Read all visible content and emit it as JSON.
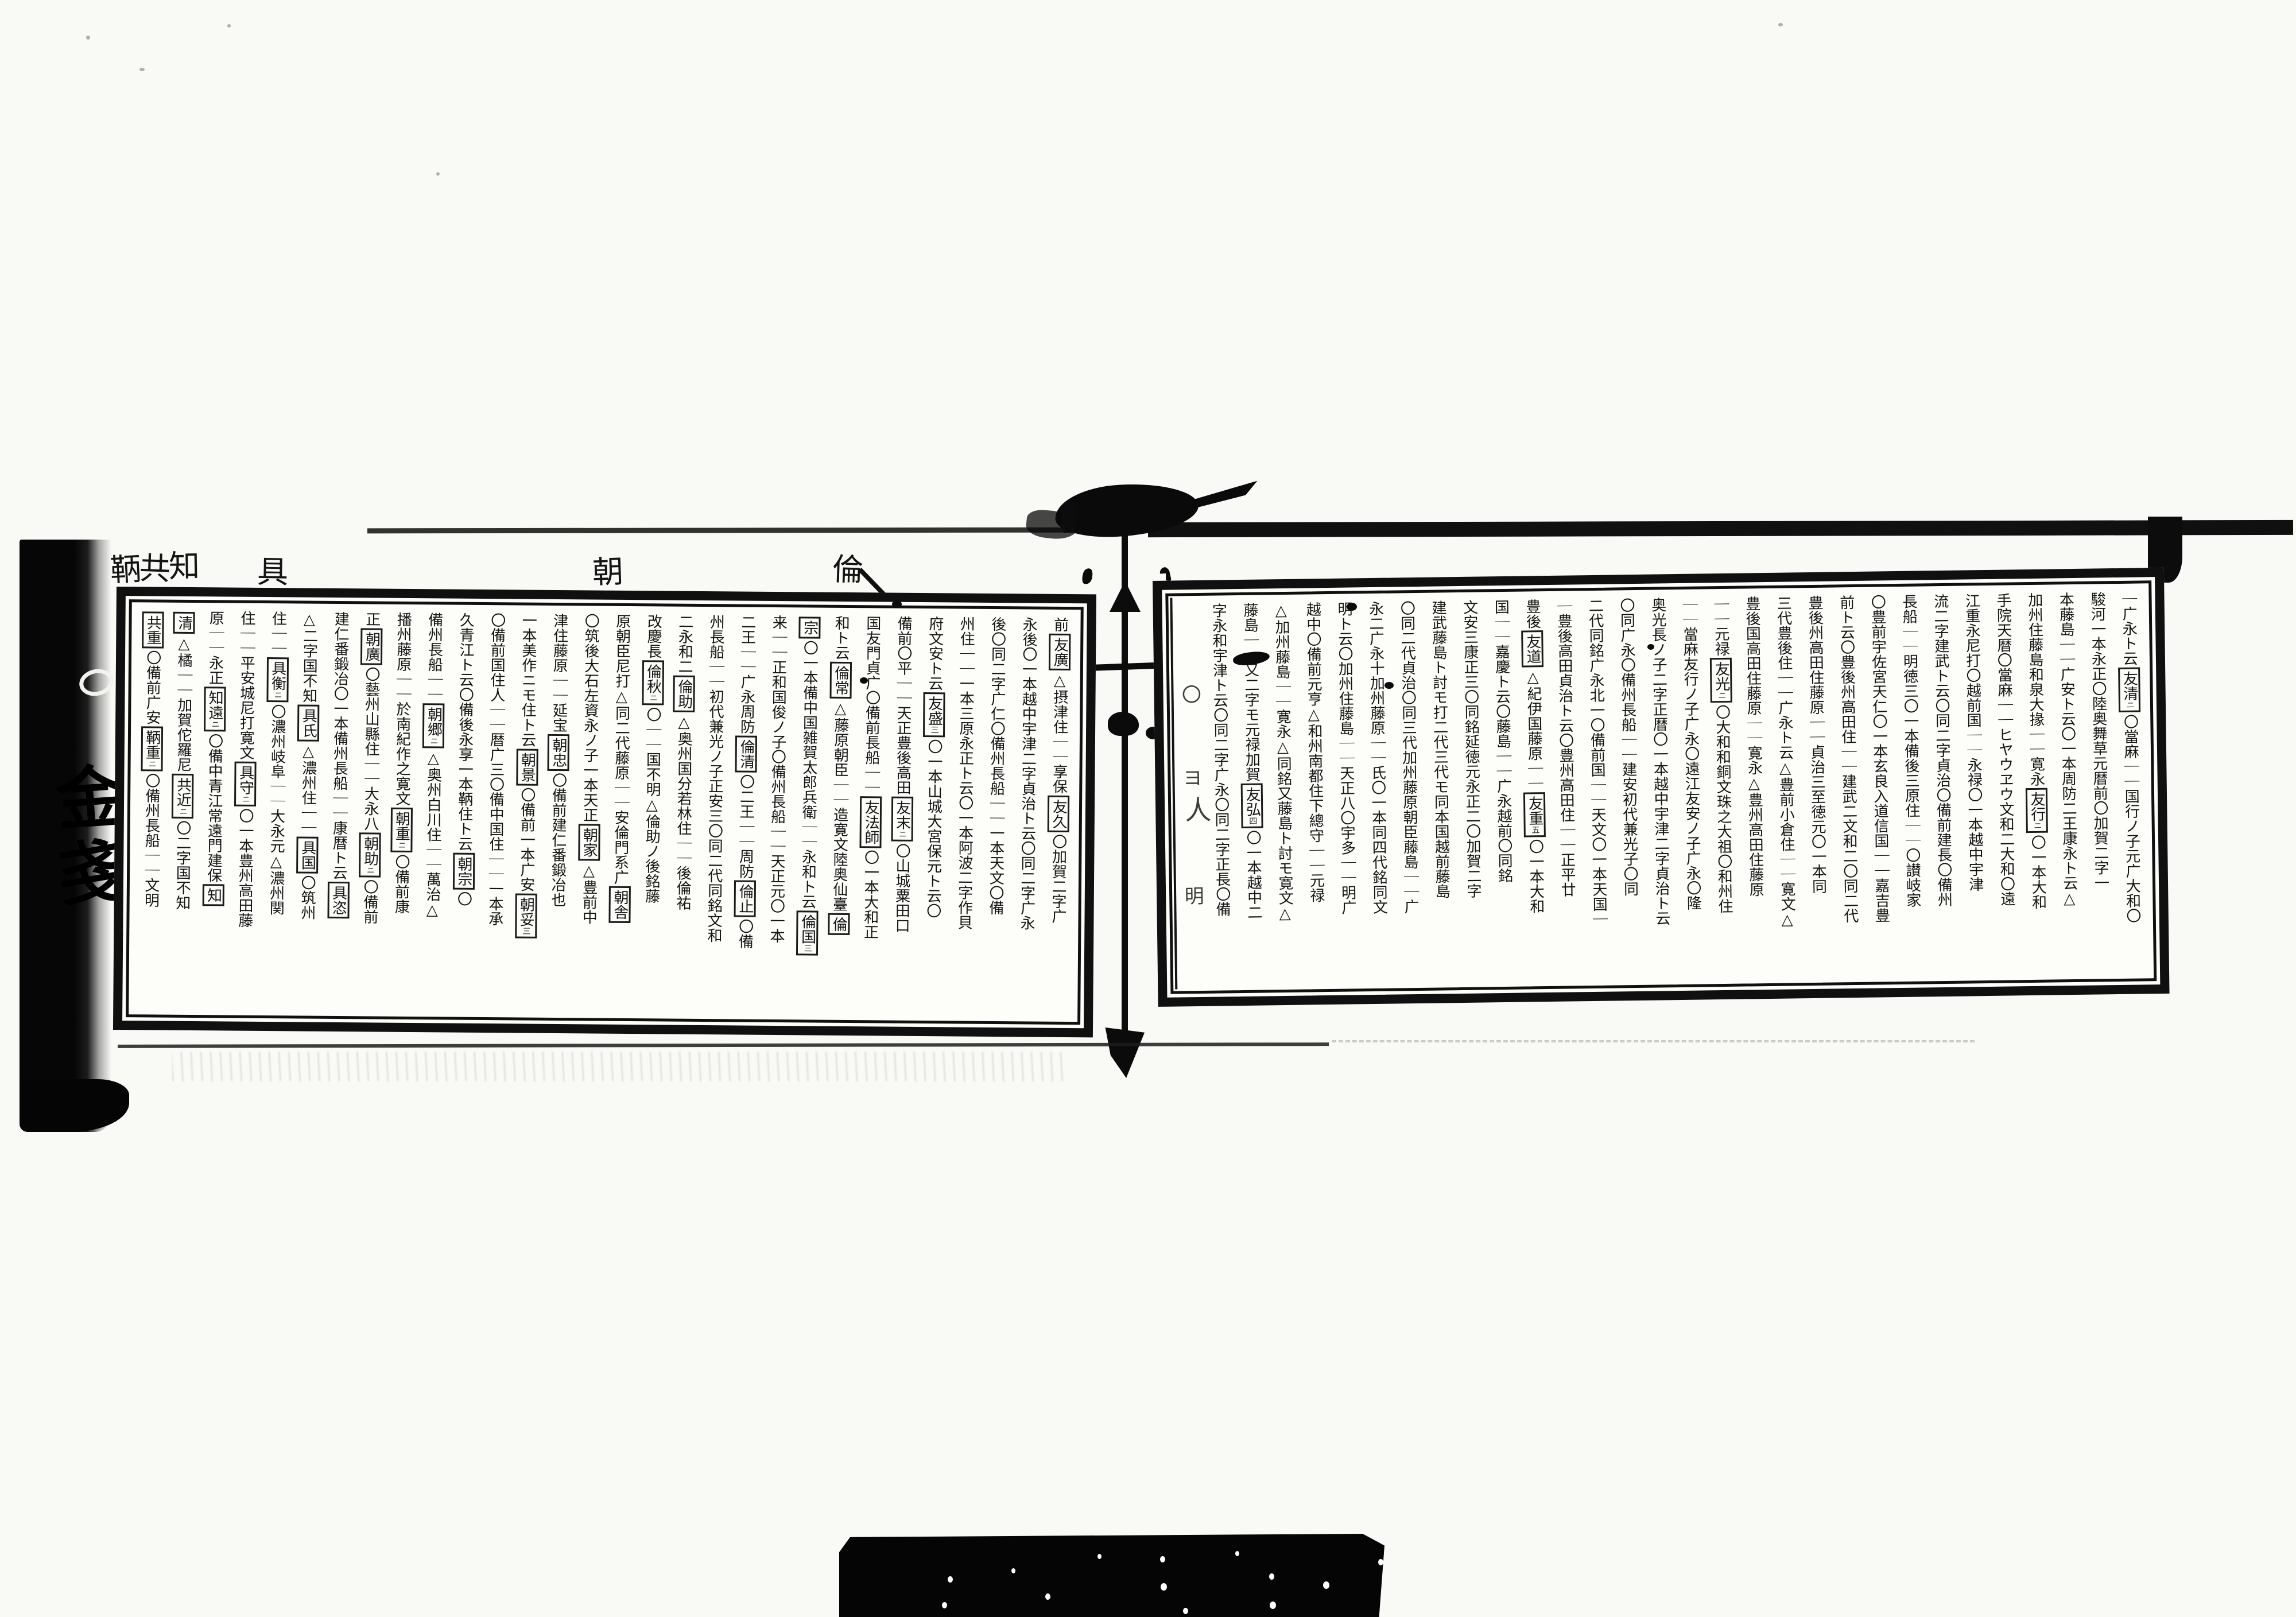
{
  "document": {
    "kind": "woodblock-printed swordsmith genealogy, two-page scanned spread, vertical kanji text read right to left"
  },
  "left_page": {
    "margin_tags": [
      "鞆",
      "共",
      "知",
      "具",
      "朝",
      "倫"
    ],
    "columns": [
      [
        "前",
        {
          "b": "友廣"
        },
        "△摂津住｜｜享保",
        {
          "b": "友久"
        },
        "〇加賀二字广"
      ],
      [
        "永後〇一本越中宇津二字貞治ト云〇同二字广永"
      ],
      [
        "後〇同二字广仁〇備州長船｜｜一本天文〇備"
      ],
      [
        "州住｜｜一本三原永正ト云〇一本阿波二字作貝"
      ],
      [
        "府文安ト云",
        {
          "b": "友盛",
          "s": "三"
        },
        "〇一本山城大宮保元ト云〇"
      ],
      [
        "備前〇平｜｜天正豊後高田",
        {
          "b": "友末",
          "s": "ニ"
        },
        "〇山城粟田口"
      ],
      [
        "国友門貞广〇備前長船｜｜",
        {
          "b": "友法師"
        },
        "〇一本大和正"
      ],
      [
        "和ト云",
        {
          "b": "倫常"
        },
        "△藤原朝臣｜｜造寛文陸奥仙臺",
        {
          "b": "倫"
        }
      ],
      [
        {
          "b": "宗"
        },
        "〇一本備中国雑賀太郎兵衛｜｜永和ト云",
        {
          "b": "倫国",
          "s": "三"
        }
      ],
      [
        "来｜｜正和国俊ノ子〇備州長船｜｜天正元〇一本"
      ],
      [
        "二王｜｜广永周防",
        {
          "b": "倫清"
        },
        "〇二王｜｜周防",
        {
          "b": "倫止"
        },
        "〇備"
      ],
      [
        "州長船｜｜初代兼光ノ子正安三〇同二代同銘文和"
      ],
      [
        "二永和二",
        {
          "b": "倫助"
        },
        "△奥州国分若林住｜｜後倫祐"
      ],
      [
        "改慶長",
        {
          "b": "倫秋",
          "s": "ニ"
        },
        "〇｜｜国不明△倫助ノ後銘藤"
      ],
      [
        "原朝臣尼打△同二代藤原｜｜安倫門系广",
        {
          "b": "朝舎"
        }
      ],
      [
        "〇筑後大石左資永ノ子一本天正",
        {
          "b": "朝家"
        },
        "△豊前中"
      ],
      [
        "津住藤原｜｜延宝",
        {
          "b": "朝忠"
        },
        "〇備前建仁番鍛冶也"
      ],
      [
        "一本美作ニモ住ト云",
        {
          "b": "朝景"
        },
        "〇備前一本广安",
        {
          "b": "朝妥",
          "s": "三"
        }
      ],
      [
        "〇備前国住人｜｜暦广三〇備中国住｜｜一本承"
      ],
      [
        "久青江ト云〇備後永享一本鞆住ト云",
        {
          "b": "朝宗"
        },
        "〇"
      ],
      [
        "備州長船｜｜",
        {
          "b": "朝郷",
          "s": "ニ"
        },
        "△奥州白川住｜｜萬治△"
      ],
      [
        "播州藤原｜｜於南紀作之寛文",
        {
          "b": "朝重",
          "s": "ニ"
        },
        "〇備前康"
      ],
      [
        "正",
        {
          "b": "朝廣"
        },
        "〇藝州山縣住｜｜大永八",
        {
          "b": "朝助",
          "s": "ニ"
        },
        "〇備前"
      ],
      [
        "建仁番鍛冶〇一本備州長船｜｜康暦ト云",
        {
          "b": "具恣"
        }
      ],
      [
        "△二字国不知",
        {
          "b": "具氏"
        },
        "△濃州住｜｜",
        {
          "b": "具国"
        },
        "〇筑州"
      ],
      [
        "住｜｜",
        {
          "b": "具衡",
          "s": "ニ"
        },
        "〇濃州岐阜｜｜大永元△濃州関"
      ],
      [
        "住｜｜平安城尼打寛文",
        {
          "b": "具守",
          "s": "ニ"
        },
        "〇一本豊州高田藤"
      ],
      [
        "原｜｜永正",
        {
          "b": "知遠",
          "s": "ニ"
        },
        "〇備中青江常遠門建保",
        {
          "b": "知"
        }
      ],
      [
        {
          "b": "清"
        },
        "△橘｜｜加賀佗羅尼",
        {
          "b": "共近",
          "s": "ニ"
        },
        "〇二字国不知"
      ],
      [
        {
          "b": "共重"
        },
        "〇備前广安",
        {
          "b": "鞆重",
          "s": "ニ"
        },
        "〇備州長船｜｜文明"
      ]
    ]
  },
  "right_page": {
    "edge_marks": [
      "〇",
      "ヨ",
      "人",
      "明"
    ],
    "columns": [
      [
        "｜广永ト云",
        {
          "b": "友清",
          "s": "ニ"
        },
        "〇當麻｜｜国行ノ子元广大和〇"
      ],
      [
        "駿河一本永正〇陸奥舞草元暦前〇加賀二字一"
      ],
      [
        "本藤島｜｜广安ト云〇一本周防二王康永ト云△"
      ],
      [
        "加州住藤島和泉大掾｜｜寛永",
        {
          "b": "友行",
          "s": "ニ"
        },
        "〇一本大和"
      ],
      [
        "手院天暦〇當麻｜｜ヒヤウヱウ文和二大和〇遠"
      ],
      [
        "江重永尼打〇越前国｜｜永禄〇一本越中宇津"
      ],
      [
        "流二字建武ト云〇同二字貞治〇備前建長〇備州"
      ],
      [
        "長船｜｜明徳三〇一本備後三原住｜｜〇讃岐家"
      ],
      [
        "〇豊前宇佐宮天仁〇一本玄良入道信国｜｜嘉吉豊"
      ],
      [
        "前ト云〇豊後州高田住｜｜建武二文和二〇同二代"
      ],
      [
        "豊後州高田住藤原｜｜貞治三至徳元〇一本同"
      ],
      [
        "三代豊後住｜｜广永ト云△豊前小倉住｜｜寛文△"
      ],
      [
        "豊後国高田住藤原｜｜寛永△豊州高田住藤原"
      ],
      [
        "｜｜元禄",
        {
          "b": "友光",
          "s": "ニ"
        },
        "〇大和和銅文珠之大祖〇和州住"
      ],
      [
        "｜｜當麻友行ノ子广永〇遠江友安ノ子广永〇隆"
      ],
      [
        "奥光長ノ子二字正暦〇一本越中宇津二字貞治ト云"
      ],
      [
        "〇同广永〇備州長船｜｜建安初代兼光子〇同"
      ],
      [
        "二代同銘广永北一〇備前国｜｜天文〇一本天国｜"
      ],
      [
        "｜豊後高田貞治ト云〇豊州高田住｜｜正平廿"
      ],
      [
        "豊後",
        {
          "b": "友道"
        },
        "△紀伊国藤原｜｜",
        {
          "b": "友重",
          "s": "五"
        },
        "〇一本大和"
      ],
      [
        "国｜｜嘉慶ト云〇藤島｜｜广永越前〇同銘"
      ],
      [
        "文安三康正三〇同銘延徳元永正二〇加賀二字"
      ],
      [
        "建武藤島ト討モ打二代三代モ同本国越前藤島"
      ],
      [
        "〇同二代貞治〇同三代加州藤原朝臣藤島｜｜广"
      ],
      [
        "永二广永十加州藤原｜｜氏〇一本同四代銘同文"
      ],
      [
        "明ト云〇加州住藤島｜｜天正八〇宇多｜｜明广"
      ],
      [
        "越中〇備前元亨△和州南都住下總守｜｜元禄"
      ],
      [
        "△加州藤島｜｜寛永△同銘又藤島ト討モ寛文△"
      ],
      [
        "藤島｜｜又二字モ元禄加賀",
        {
          "b": "友弘",
          "s": "四"
        },
        "〇一本越中二"
      ],
      [
        "字永和宇津ト云〇同二字广永〇同二字正長〇備"
      ]
    ]
  },
  "cover_edge": {
    "glyphs": [
      "金",
      "戔"
    ],
    "tick": "ト"
  }
}
